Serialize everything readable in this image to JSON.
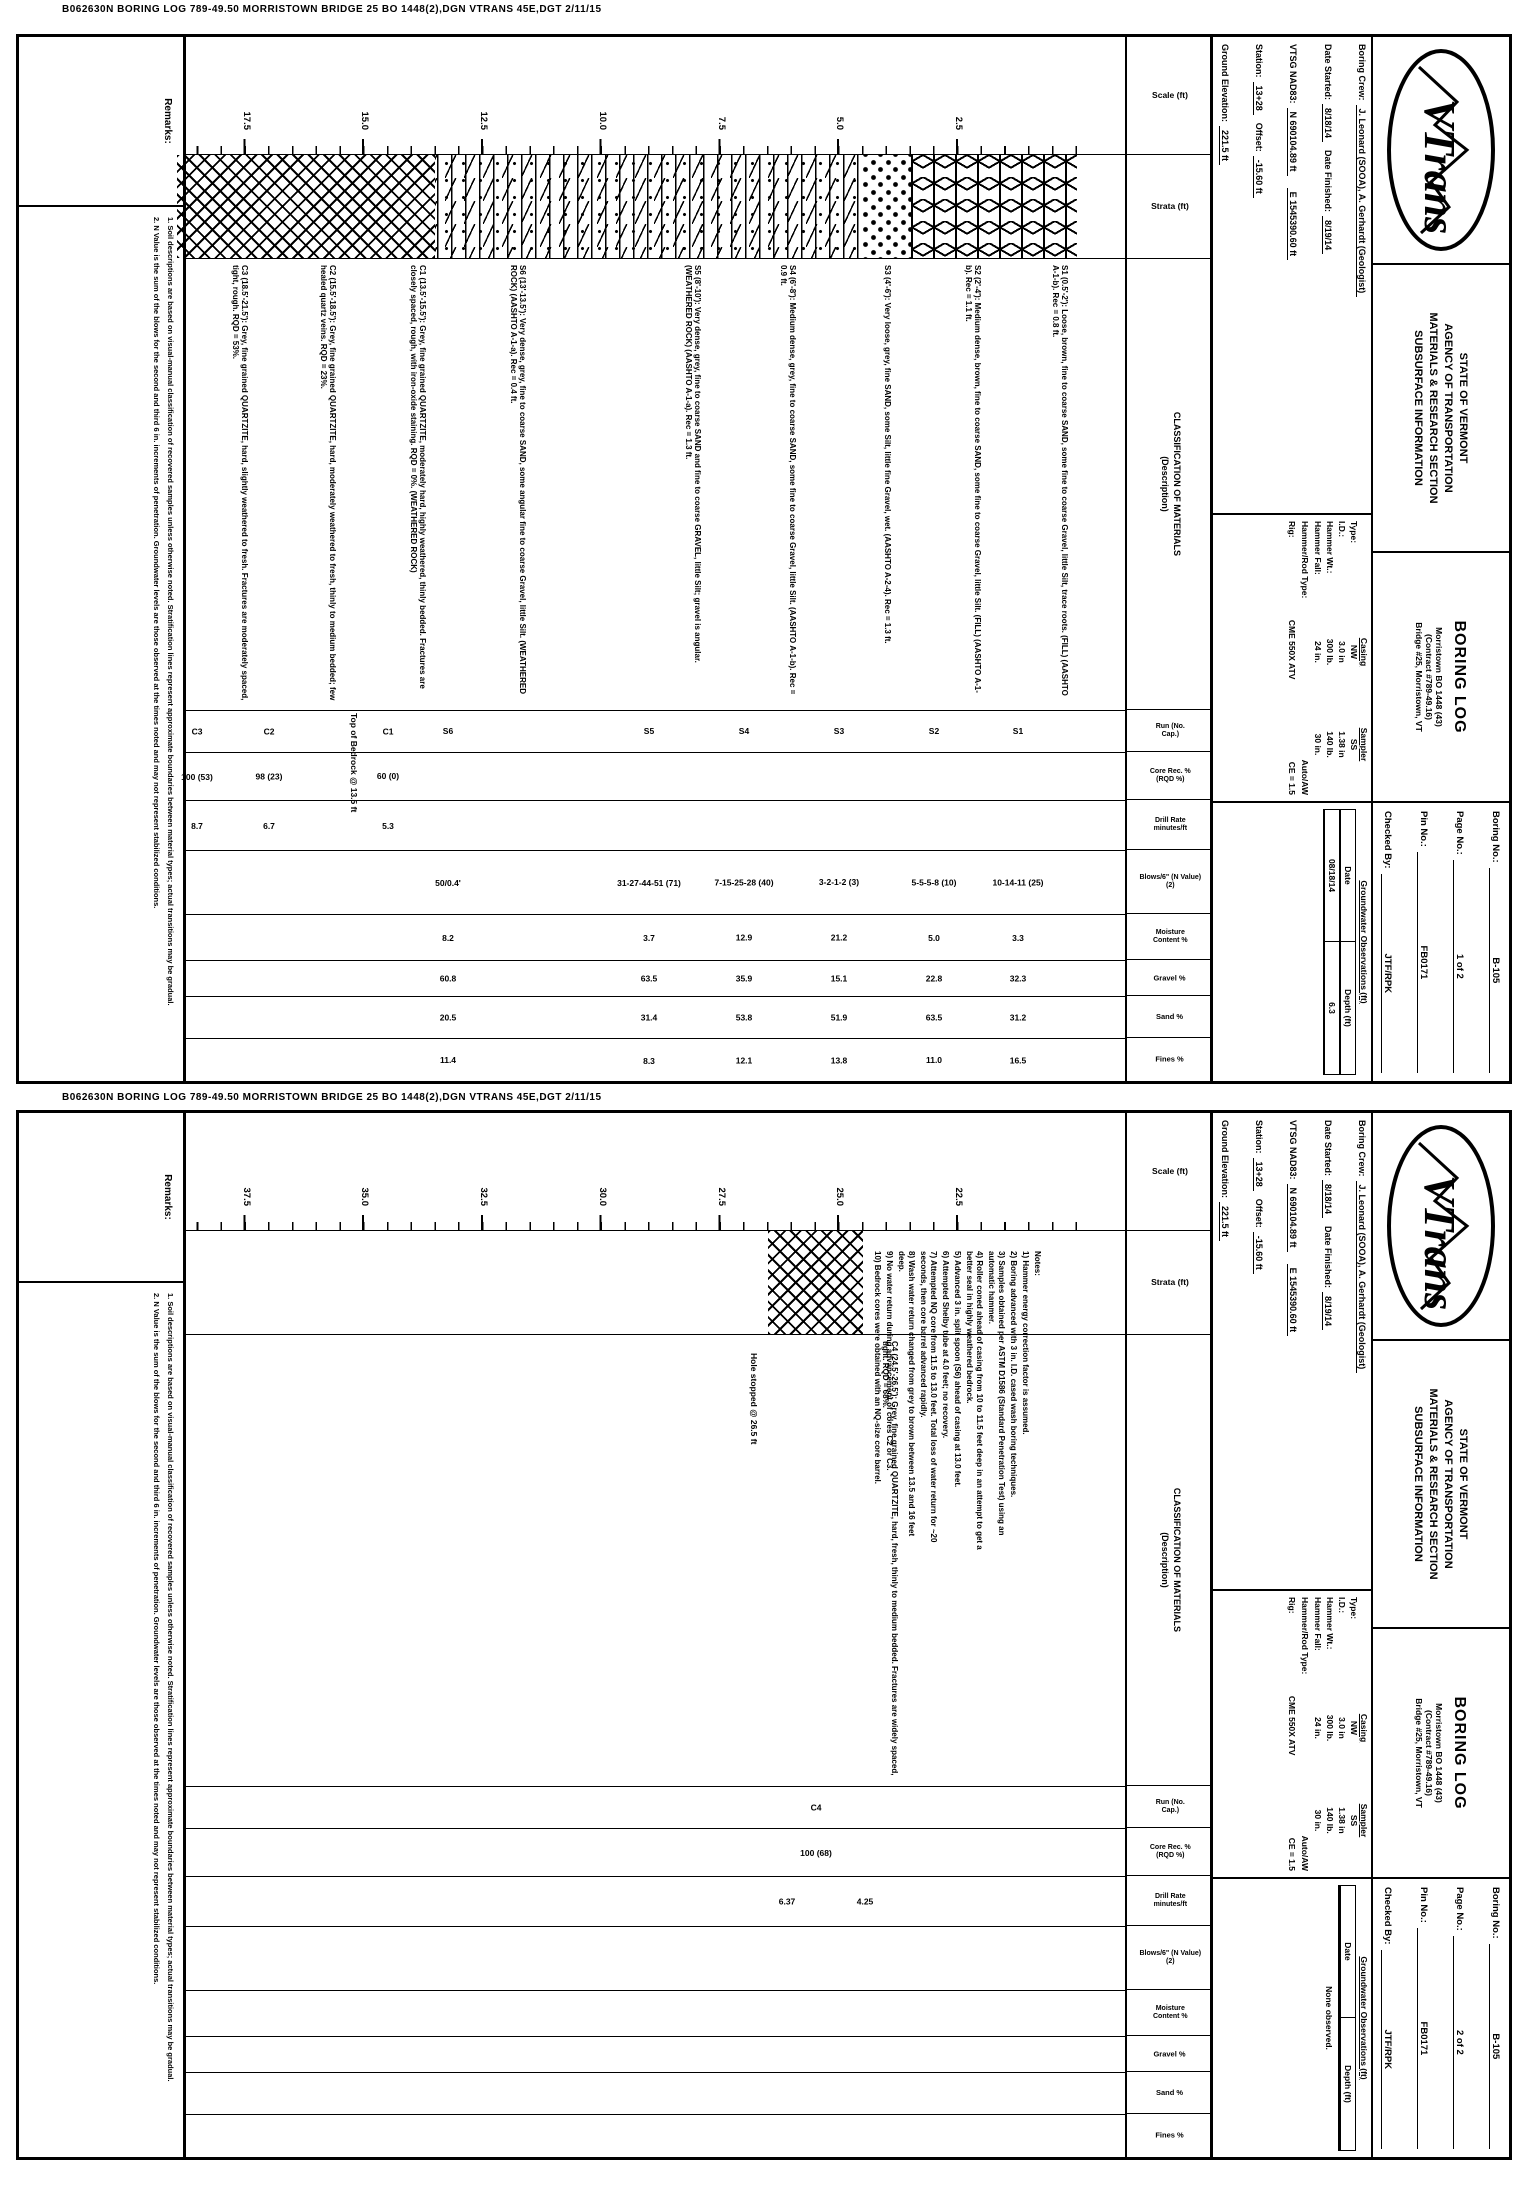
{
  "stamp": {
    "text": "B062630N  BORING LOG  789-49.50  MORRISTOWN BRIDGE 25 BO 1448(2),DGN   VTRANS 45E,DGT   2/11/15"
  },
  "org": {
    "logo_text": "VTrans",
    "lines": [
      {
        "t": "STATE OF VERMONT"
      },
      {
        "t": "AGENCY OF TRANSPORTATION"
      },
      {
        "t": "MATERIALS & RESEARCH SECTION"
      },
      {
        "t": "SUBSURFACE INFORMATION"
      }
    ]
  },
  "project": {
    "title": "BORING LOG",
    "lines": [
      {
        "t": "Morristown BO 1448 (43)"
      },
      {
        "t": "(Contract #789-49.16)"
      },
      {
        "t": "Bridge #25, Morristown, VT"
      }
    ]
  },
  "fields": {
    "crew_label": "Boring Crew:",
    "crew": "J. Leonard (SOOA), A. Gerhardt (Geologist)",
    "started_label": "Date Started:",
    "started": "8/18/14",
    "finished_label": "Date Finished:",
    "finished": "8/19/14",
    "grid_label": "VTSG NAD83:",
    "north": "N 690104.89 ft",
    "east": "E 1545390.60 ft",
    "station_label": "Station:",
    "station": "13+28",
    "offset_label": "Offset:",
    "offset": "-15.60 ft",
    "elev_label": "Ground Elevation:",
    "elev": "221.5 ft"
  },
  "casing": {
    "casing_h": "Casing",
    "sampler_h": "Sampler",
    "rows": [
      {
        "label": "Type:",
        "c": "NW",
        "s": "SS"
      },
      {
        "label": "I.D.:",
        "c": "3.0 in",
        "s": "1.38 in"
      },
      {
        "label": "Hammer Wt.:",
        "c": "300 lb.",
        "s": "140 lb."
      },
      {
        "label": "Hammer Fall:",
        "c": "24 in.",
        "s": "30 in."
      }
    ],
    "extra1_label": "Hammer/Rod Type:",
    "extra1": "Auto/AW",
    "extra2_label": "Rig:",
    "extra2": "CME 550X ATV",
    "ce": "CE = 1.5"
  },
  "columns": {
    "scale": "Scale (ft)",
    "strata": "Strata (ft)",
    "class1": "CLASSIFICATION OF MATERIALS",
    "class2": "(Description)",
    "run": "Run (No. Cap.)",
    "crec": "Core Rec. % (RQD %)",
    "drill": "Drill Rate minutes/ft",
    "blows": "Blows/6\" (N Value)(2)",
    "moist": "Moisture Content %",
    "grav": "Gravel %",
    "sand": "Sand %",
    "fines": "Fines %"
  },
  "footer": {
    "label": "Remarks:",
    "lines": [
      {
        "t": "1. Soil descriptions are based on visual-manual classification of recovered samples unless otherwise noted. Stratification lines represent approximate boundaries between material types; actual transitions may be gradual."
      },
      {
        "t": "2. N Value is the sum of the blows for the second and third 6 in. increments of penetration. Groundwater levels are those observed at the times noted and may not represent stabilized conditions."
      }
    ]
  },
  "pages": [
    {
      "info": {
        "boring_label": "Boring No.:",
        "boring": "B-105",
        "page_label": "Page No.:",
        "page": "1 of 2",
        "pin_label": "Pin No.:",
        "pin": "FB0171",
        "checked_label": "Checked By:",
        "checked": "JTF/RPK"
      },
      "groundwater": {
        "title": "Groundwater Observations (ft)",
        "date_h": "Date",
        "depth_h": "Depth (ft)",
        "rows": [
          {
            "date": "08/18/14",
            "depth": "6.3"
          }
        ],
        "note": ""
      },
      "scale": [
        {
          "y": 169,
          "t": "2.5"
        },
        {
          "y": 288,
          "t": "5.0"
        },
        {
          "y": 406,
          "t": "7.5"
        },
        {
          "y": 525,
          "t": "10.0"
        },
        {
          "y": 644,
          "t": "12.5"
        },
        {
          "y": 763,
          "t": "15.0"
        },
        {
          "y": 881,
          "t": "17.5"
        }
      ],
      "zones": [
        {
          "top": 50,
          "h": 166,
          "pat": "pat-stars"
        },
        {
          "top": 216,
          "h": 48,
          "pat": "pat-dots"
        },
        {
          "top": 264,
          "h": 428,
          "pat": "pat-wavy"
        },
        {
          "top": 692,
          "h": 258,
          "pat": "pat-hatch"
        }
      ],
      "descs": [
        {
          "top": 58,
          "text": "S1 (0.5'-2'): Loose, brown, fine to coarse SAND, some fine to coarse Gravel, little Silt, trace roots. (FILL) (AASHTO A-1-b). Rec = 0.8 ft."
        },
        {
          "top": 145,
          "text": "S2 (2'-4'): Medium dense, brown, fine to coarse SAND, some fine to coarse Gravel, little Silt. (FILL) (AASHTO A-1-b). Rec = 1.1 ft."
        },
        {
          "top": 235,
          "text": "S3 (4'-6'): Very loose, grey, fine SAND, some Silt, little fine Gravel, wet. (AASHTO A-2-4). Rec = 1.3 ft."
        },
        {
          "top": 330,
          "text": "S4 (6'-8'): Medium dense, grey, fine to coarse SAND, some fine to coarse Gravel, little Silt. (AASHTO A-1-b). Rec = 0.9 ft."
        },
        {
          "top": 425,
          "text": "S5 (8'-10'): Very dense, grey, fine to coarse SAND and fine to coarse GRAVEL, little Silt; gravel is angular. (WEATHERED ROCK) (AASHTO A-1-a). Rec = 1.3 ft."
        },
        {
          "top": 600,
          "text": "S6 (13'-13.5'): Very dense, grey, fine to coarse SAND, some angular fine to coarse Gravel, little Silt. (WEATHERED ROCK) (AASHTO A-1-a). Rec = 0.4 ft."
        },
        {
          "top": 700,
          "text": "C1 (13.5'-15.5'): Grey, fine grained QUARTZITE, moderately hard, highly weathered, thinly bedded. Fractures are closely spaced, rough, with iron-oxide staining. RQD = 0%. (WEATHERED ROCK)"
        },
        {
          "top": 790,
          "text": "C2 (15.5'-18.5'): Grey, fine grained QUARTZITE, hard, moderately weathered to fresh, thinly to medium bedded; few healed quartz veins. RQD = 23%."
        },
        {
          "top": 878,
          "text": "C3 (18.5'-21.5'): Grey, fine grained QUARTZITE, hard, slightly weathered to fresh. Fractures are moderately spaced, tight, rough. RQD = 53%."
        }
      ],
      "annos": [
        {
          "top": 768,
          "left": 676,
          "text": "Top of Bedrock @ 13.5 ft"
        }
      ],
      "notes": [],
      "rows": {
        "run": [
          {
            "y": 109,
            "v": "S1"
          },
          {
            "y": 193,
            "v": "S2"
          },
          {
            "y": 288,
            "v": "S3"
          },
          {
            "y": 383,
            "v": "S4"
          },
          {
            "y": 478,
            "v": "S5"
          },
          {
            "y": 679,
            "v": "S6"
          },
          {
            "y": 739,
            "v": "C1"
          },
          {
            "y": 858,
            "v": "C2"
          },
          {
            "y": 930,
            "v": "C3"
          }
        ],
        "crec": [
          {
            "y": 739,
            "v": "60 (0)"
          },
          {
            "y": 858,
            "v": "98 (23)"
          },
          {
            "y": 930,
            "v": "100 (53)"
          }
        ],
        "drill": [
          {
            "y": 739,
            "v": "5.3"
          },
          {
            "y": 858,
            "v": "6.7"
          },
          {
            "y": 930,
            "v": "8.7"
          }
        ],
        "blows": [
          {
            "y": 109,
            "v": "10-14-11 (25)"
          },
          {
            "y": 193,
            "v": "5-5-5-8 (10)"
          },
          {
            "y": 288,
            "v": "3-2-1-2 (3)"
          },
          {
            "y": 383,
            "v": "7-15-25-28 (40)"
          },
          {
            "y": 478,
            "v": "31-27-44-51 (71)"
          },
          {
            "y": 679,
            "v": "50/0.4'"
          }
        ],
        "moist": [
          {
            "y": 109,
            "v": "3.3"
          },
          {
            "y": 193,
            "v": "5.0"
          },
          {
            "y": 288,
            "v": "21.2"
          },
          {
            "y": 383,
            "v": "12.9"
          },
          {
            "y": 478,
            "v": "3.7"
          },
          {
            "y": 679,
            "v": "8.2"
          }
        ],
        "grav": [
          {
            "y": 109,
            "v": "32.3"
          },
          {
            "y": 193,
            "v": "22.8"
          },
          {
            "y": 288,
            "v": "15.1"
          },
          {
            "y": 383,
            "v": "35.9"
          },
          {
            "y": 478,
            "v": "63.5"
          },
          {
            "y": 679,
            "v": "60.8"
          }
        ],
        "sand": [
          {
            "y": 109,
            "v": "31.2"
          },
          {
            "y": 193,
            "v": "63.5"
          },
          {
            "y": 288,
            "v": "51.9"
          },
          {
            "y": 383,
            "v": "53.8"
          },
          {
            "y": 478,
            "v": "31.4"
          },
          {
            "y": 679,
            "v": "20.5"
          }
        ],
        "fines": [
          {
            "y": 109,
            "v": "16.5"
          },
          {
            "y": 193,
            "v": "11.0"
          },
          {
            "y": 288,
            "v": "13.8"
          },
          {
            "y": 383,
            "v": "12.1"
          },
          {
            "y": 478,
            "v": "8.3"
          },
          {
            "y": 679,
            "v": "11.4"
          }
        ]
      }
    },
    {
      "info": {
        "boring_label": "Boring No.:",
        "boring": "B-105",
        "page_label": "Page No.:",
        "page": "2 of 2",
        "pin_label": "Pin No.:",
        "pin": "FB0171",
        "checked_label": "Checked By:",
        "checked": "JTF/RPK"
      },
      "groundwater": {
        "title": "Groundwater Observations (ft)",
        "date_h": "Date",
        "depth_h": "Depth (ft)",
        "rows": [],
        "note": "None observed."
      },
      "scale": [
        {
          "y": 169,
          "t": "22.5"
        },
        {
          "y": 288,
          "t": "25.0"
        },
        {
          "y": 406,
          "t": "27.5"
        },
        {
          "y": 525,
          "t": "30.0"
        },
        {
          "y": 644,
          "t": "32.5"
        },
        {
          "y": 763,
          "t": "35.0"
        },
        {
          "y": 881,
          "t": "37.5"
        }
      ],
      "zones": [
        {
          "top": 264,
          "h": 95,
          "pat": "pat-hatch"
        }
      ],
      "descs": [
        {
          "top": 228,
          "text": "C4 (24.5'-26.5'): Grey, fine grained QUARTZITE, hard, fresh, thinly to medium bedded. Fractures are widely spaced, tight. RQD = 68%."
        }
      ],
      "annos": [
        {
          "top": 368,
          "left": 240,
          "text": "Hole stopped @ 26.5 ft"
        }
      ],
      "notes": [
        {
          "t": "Notes:"
        },
        {
          "t": "1) Hammer energy correction factor is assumed."
        },
        {
          "t": "2) Boring advanced with 3 in. I.D. cased wash boring techniques."
        },
        {
          "t": "3) Samples obtained per ASTM D1586 (Standard Penetration Test) using an automatic hammer."
        },
        {
          "t": "4) Roller coned ahead of casing from 10 to 11.5 feet deep in an attempt to get a better seal in highly weathered bedrock."
        },
        {
          "t": "5) Advanced 3 in. split spoon (S6) ahead of casing at 13.0 feet."
        },
        {
          "t": "6) Attempted Shelby tube at 4.0 feet; no recovery."
        },
        {
          "t": "7) Attempted NQ core from 11.5 to 13.0 feet. Total loss of water return for ~20 seconds, then core barrel advanced rapidly."
        },
        {
          "t": "8) Wash water return changed from grey to brown between 13.5 and 16 feet deep."
        },
        {
          "t": "9) No water return during advancement of cores C2 or C3."
        },
        {
          "t": "10) Bedrock cores were obtained with an NQ-size core barrel."
        }
      ],
      "rows": {
        "run": [
          {
            "y": 311,
            "v": "C4"
          }
        ],
        "crec": [
          {
            "y": 311,
            "v": "100 (68)"
          }
        ],
        "drill": [
          {
            "y": 262,
            "v": "4.25"
          },
          {
            "y": 340,
            "v": "6.37"
          }
        ],
        "blows": [],
        "moist": [],
        "grav": [],
        "sand": [],
        "fines": []
      }
    }
  ]
}
